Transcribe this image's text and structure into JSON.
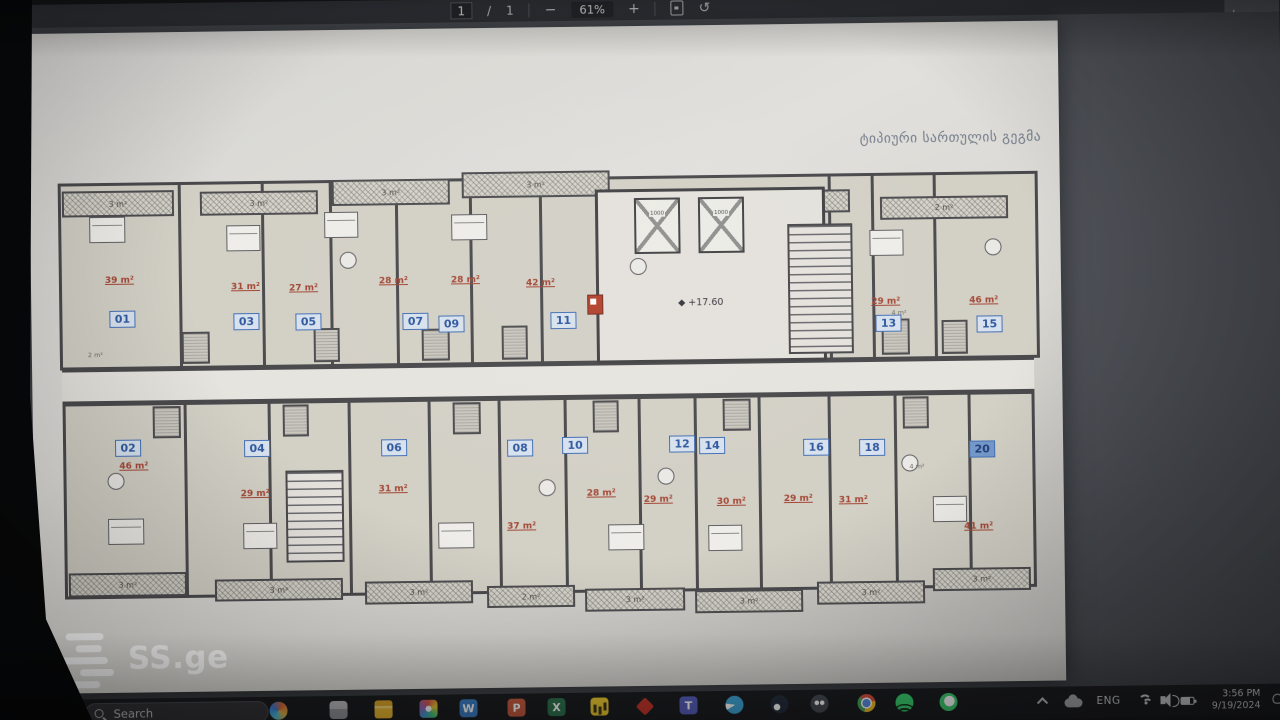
{
  "viewer": {
    "page_current": "1",
    "page_separator": "/",
    "page_total": "1",
    "zoom_level": "61%",
    "controls": {
      "zoom_out": "−",
      "zoom_in": "+",
      "rotate_glyph": "↺"
    },
    "icons": {
      "fit_page": "fit-to-page-icon",
      "rotate": "rotate-counterclockwise-icon",
      "download": "download-icon",
      "download_glyph": "⭳"
    }
  },
  "plan": {
    "title": "ტიპიური სართულის გეგმა",
    "level_mark": "+17.60",
    "elevator_label": "1000",
    "units": [
      {
        "number": "01",
        "area": "39 m²"
      },
      {
        "number": "03",
        "area": "31 m²"
      },
      {
        "number": "05",
        "area": "27 m²"
      },
      {
        "number": "07",
        "area": "28 m²"
      },
      {
        "number": "09",
        "area": "28 m²"
      },
      {
        "number": "11",
        "area": "42 m²"
      },
      {
        "number": "13",
        "area": "29 m²"
      },
      {
        "number": "15",
        "area": "46 m²"
      },
      {
        "number": "02",
        "area": "46 m²"
      },
      {
        "number": "04",
        "area": "29 m²"
      },
      {
        "number": "06",
        "area": "31 m²"
      },
      {
        "number": "08",
        "area": "37 m²"
      },
      {
        "number": "10",
        "area": "28 m²"
      },
      {
        "number": "12",
        "area": "29 m²"
      },
      {
        "number": "14",
        "area": "30 m²"
      },
      {
        "number": "16",
        "area": "29 m²"
      },
      {
        "number": "18",
        "area": "31 m²"
      },
      {
        "number": "20",
        "area": "41 m²"
      }
    ],
    "balconies_top": [
      "3 m²",
      "3 m²",
      "3 m²",
      "3 m²",
      "3 m²",
      "2 m²"
    ],
    "balconies_bottom": [
      "3 m²",
      "3 m²",
      "3 m²",
      "2 m²",
      "3 m²",
      "3 m²",
      "3 m²",
      "3 m²"
    ],
    "small_labels": [
      "2 m²",
      "4 m²",
      "4 m²"
    ]
  },
  "watermark": {
    "text": "SS.ge"
  },
  "taskbar": {
    "search_placeholder": "Search",
    "language": "ENG",
    "clock": {
      "time": "3:56 PM",
      "date": "9/19/2024"
    },
    "glyphs": {
      "word": "W",
      "powerpoint": "P",
      "excel": "X",
      "teams": "T"
    },
    "apps": [
      "start",
      "search",
      "copilot",
      "widgets-app",
      "file-explorer",
      "photos",
      "word",
      "powerpoint",
      "excel",
      "power-bi",
      "autocad",
      "teams",
      "telegram",
      "steam",
      "discord",
      "chrome",
      "spotify",
      "whatsapp"
    ],
    "tray": [
      "tray-chevron",
      "onedrive",
      "language",
      "wifi",
      "volume",
      "battery",
      "clock",
      "notifications"
    ]
  },
  "colors": {
    "unit_number_blue": "#2456b0",
    "area_red": "#b2402a",
    "page_bg": "#e0ded9",
    "viewer_bg": "#4a4e56",
    "taskbar_bg": "#141519"
  }
}
